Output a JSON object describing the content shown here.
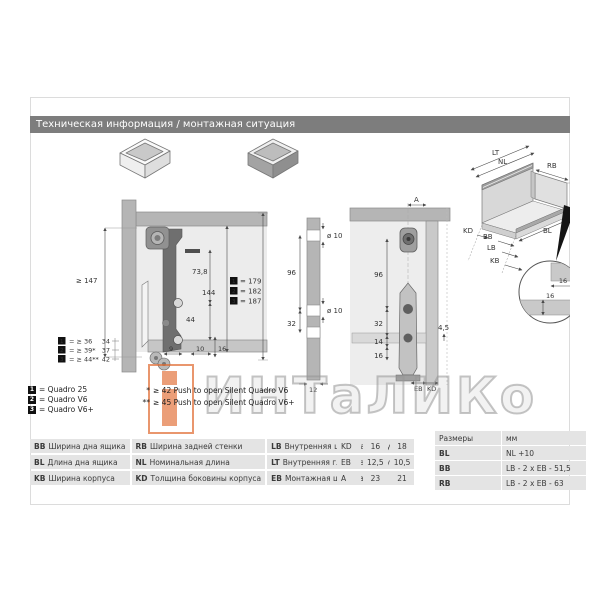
{
  "header": {
    "title": "Техническая информация / монтажная ситуация"
  },
  "watermark": {
    "text": "ИНТаЛИКо"
  },
  "side_view": {
    "dim_height_min": "≥ 147",
    "dim_top": "73,8",
    "dim_mid": "144",
    "dim_low": "44",
    "dim_b1": "9",
    "dim_b2": "10",
    "dim_b3": "16",
    "stack": [
      {
        "num": "1",
        "val": "= ≥ 36",
        "alt": "34"
      },
      {
        "num": "2",
        "val": "= ≥ 39*",
        "alt": "37"
      },
      {
        "num": "3",
        "val": "= ≥ 44**",
        "alt": "42"
      }
    ],
    "heights": [
      {
        "num": "1",
        "val": "= 179"
      },
      {
        "num": "2",
        "val": "= 182"
      },
      {
        "num": "3",
        "val": "= 187"
      }
    ]
  },
  "panel_view": {
    "dia_top": "ø 10",
    "dia_mid": "ø 10",
    "dim_96": "96",
    "dim_32": "32",
    "dim_12": "12"
  },
  "section_view": {
    "dim_a": "A",
    "dim_96": "96",
    "dim_32": "32",
    "dim_14": "14",
    "dim_16": "16",
    "dim_gap": "4,5",
    "label_eb": "EB",
    "label_kd": "KD"
  },
  "iso_view": {
    "lt": "LT",
    "nl": "NL",
    "rb": "RB",
    "dim_144": "144",
    "bl": "BL",
    "kd": "KD",
    "bb": "BB",
    "lb": "LB",
    "kb": "KB",
    "detail_h": "16",
    "detail_v": "16"
  },
  "legend": [
    {
      "num": "1",
      "label": "= Quadro 25"
    },
    {
      "num": "2",
      "label": "= Quadro V6"
    },
    {
      "num": "3",
      "label": "= Quadro V6+"
    }
  ],
  "notes": [
    {
      "marker": "*",
      "text": "≥ 42 Push to open Silent Quadro V6"
    },
    {
      "marker": "**",
      "text": "≥ 45 Push to open Silent Quadro V6+"
    }
  ],
  "tables": {
    "abbr": [
      [
        {
          "k": "BB",
          "v": "Ширина дна ящика"
        },
        {
          "k": "RB",
          "v": "Ширина задней стенки"
        },
        {
          "k": "LB",
          "v": "Внутренняя ширина корпуса"
        }
      ],
      [
        {
          "k": "BL",
          "v": "Длина дна ящика"
        },
        {
          "k": "NL",
          "v": "Номинальная длина"
        },
        {
          "k": "LT",
          "v": "Внутренняя глубина корпуса"
        }
      ],
      [
        {
          "k": "KB",
          "v": "Ширина корпуса"
        },
        {
          "k": "KD",
          "v": "Толщина боковины корпуса"
        },
        {
          "k": "EB",
          "v": "Монтажная ширина"
        }
      ]
    ],
    "values": [
      [
        "KD",
        "16",
        "18"
      ],
      [
        "EB",
        "12,5",
        "10,5"
      ],
      [
        "A",
        "23",
        "21"
      ]
    ],
    "formulas": {
      "header": [
        "Размеры",
        "мм"
      ],
      "rows": [
        [
          "BL",
          "NL +10"
        ],
        [
          "BB",
          "LB - 2 x EB - 51,5"
        ],
        [
          "RB",
          "LB - 2 x EB - 63"
        ]
      ]
    }
  }
}
